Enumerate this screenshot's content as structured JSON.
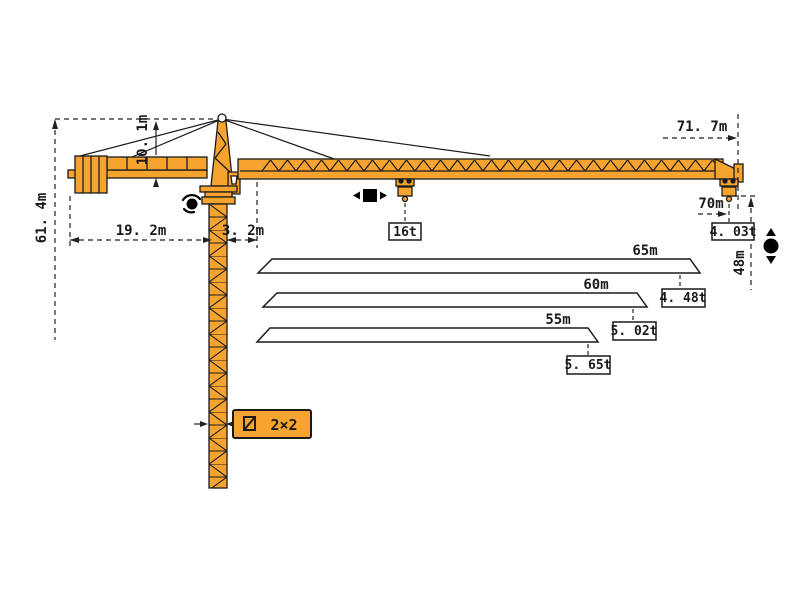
{
  "title": "tower-crane-dimension-diagram",
  "colors": {
    "crane_fill": "#F6A42F",
    "outline": "#1a1a1a",
    "dimension_lines": "#222222",
    "label_box_bg": "#ffffff"
  },
  "dimensions": {
    "overall_height": "61. 4m",
    "tower_head_height": "10. 1m",
    "counter_jib_radius": "19. 2m",
    "jib_root_offset": "3. 2m",
    "jib_tip_radius": "71. 7m",
    "working_radius": "70m",
    "lifting_height": "48m"
  },
  "loads": {
    "max_capacity": "16t",
    "tip_load_at_70m": "4. 03t"
  },
  "jib_configurations": [
    {
      "length": "65m",
      "tip_load": "4. 48t"
    },
    {
      "length": "60m",
      "tip_load": "5. 02t"
    },
    {
      "length": "55m",
      "tip_load": "5. 65t"
    }
  ],
  "mast_section": {
    "label": "2×2"
  },
  "icons": {
    "slewing": "slew-rotation-icon",
    "trolley_travel": "trolley-travel-arrows-icon",
    "hoisting": "hook-up-down-icon",
    "mast_section_symbol": "square-section-icon"
  }
}
